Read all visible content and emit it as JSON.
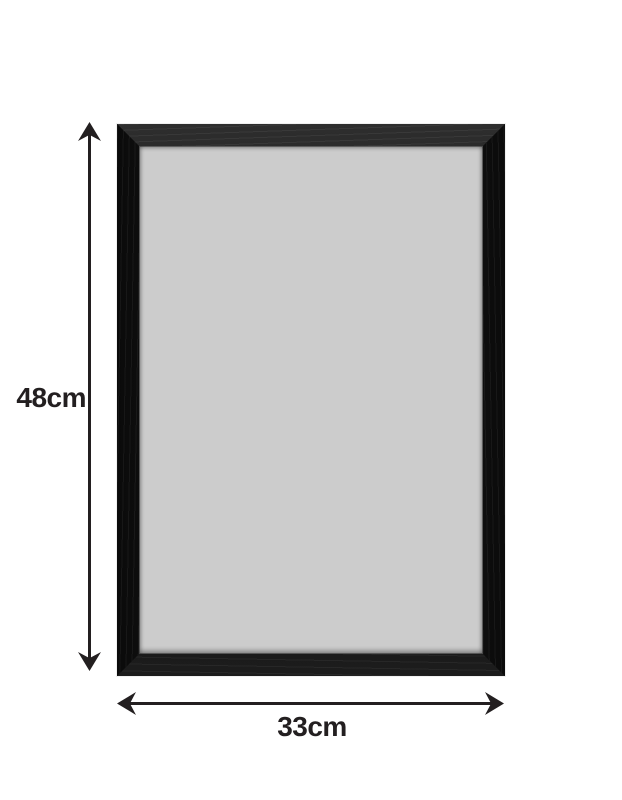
{
  "diagram": {
    "description": "black picture frame product dimension diagram",
    "height_dimension": {
      "label": "48cm"
    },
    "width_dimension": {
      "label": "33cm"
    }
  },
  "colors": {
    "background": "#ffffff",
    "frame": "#121212",
    "opening": "#cccccc",
    "dimension": "#231f20"
  }
}
